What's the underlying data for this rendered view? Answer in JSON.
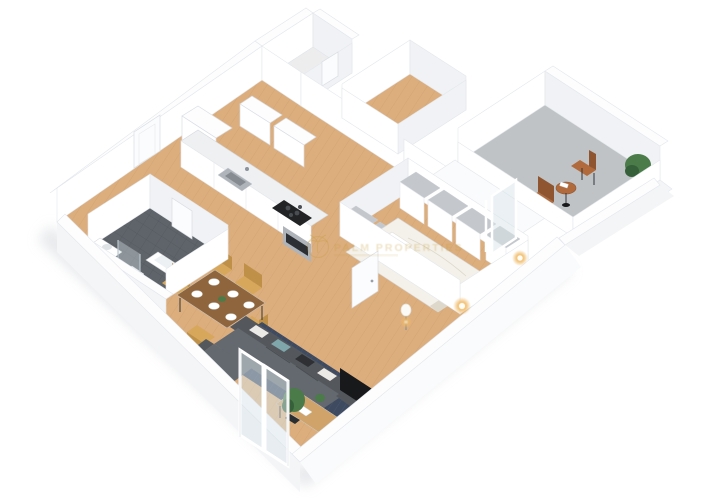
{
  "watermark": {
    "brand": "PALM PROPERTIES",
    "icon": "palm-tree-icon"
  },
  "palette": {
    "wood": "#dcae7e",
    "plank": "#bc905f",
    "storage_floor": "#ededee",
    "bath_floor": "#5f646a",
    "bath_line": "#51565c",
    "balcony_floor": "#bfc3c5",
    "wall": "#ffffff",
    "wall_shade": "#f0f2f5",
    "wall_top": "#fdfdfe",
    "exterior": "#f4f5f7",
    "exterior_bright": "#fafbfc",
    "shadow": "#d3d7dc",
    "rug": "#3e4a60",
    "rug_light": "#5b6a84",
    "sofa": "#54585d",
    "sofa_light": "#63696f",
    "sofa_dark": "#43474c",
    "pillow_white": "#eceae6",
    "pillow_teal": "#7fa6ab",
    "pillow_black": "#2e3033",
    "chair": "#d7a75b",
    "chair_dark": "#bf9148",
    "table_wood": "#8f653d",
    "coffee": "#cfa369",
    "black": "#17191b",
    "green": "#4a7b48",
    "green_dark": "#35603a",
    "pot": "#2b2e31",
    "bed": "#f4f1ea",
    "bed_shade": "#ded8ca",
    "steel": "#aeb4ba",
    "marble": "#eef0f2",
    "cook": "#212325",
    "glass": "#d9e5ea",
    "glow": "#f0b964",
    "glow_core": "#fff6e2",
    "gold": "#c49a33",
    "gray_top": "#c4c8cc",
    "door": "#fbfcfd",
    "balcony_chair": "#b06a3b",
    "balcony_chair_dark": "#8f5530"
  }
}
